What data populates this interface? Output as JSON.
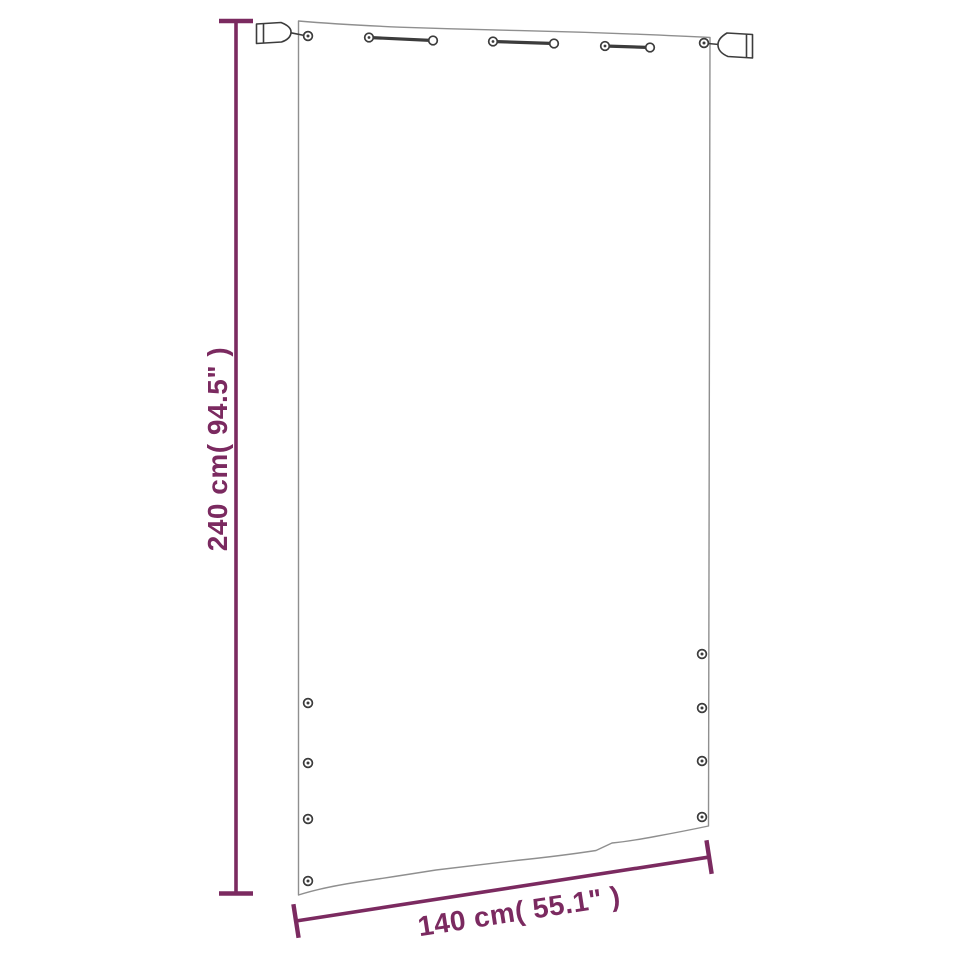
{
  "colors": {
    "accent": "#7b2a60",
    "panel_outline": "#8f8f8f",
    "hardware": "#3c3c3c",
    "background": "#ffffff"
  },
  "dimensions": {
    "height": {
      "label": "240 cm( 94.5\" )",
      "cm": 240,
      "inches": 94.5
    },
    "width": {
      "label": "140 cm( 55.1\" )",
      "cm": 140,
      "inches": 55.1
    }
  },
  "hardware": {
    "end_clips": 2,
    "top_ties": 3,
    "corner_rings": 2,
    "left_grommets": 4,
    "right_grommets": 4
  }
}
